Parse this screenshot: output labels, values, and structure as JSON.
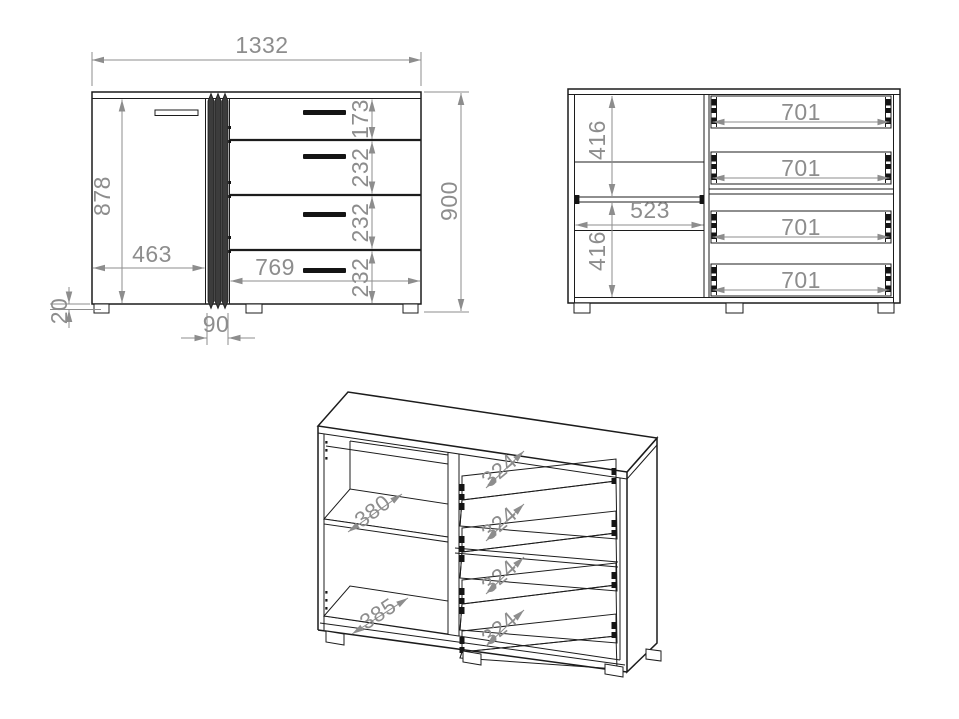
{
  "drawing": {
    "front_view": {
      "total_width": "1332",
      "total_height": "900",
      "front_height": "878",
      "door_width": "463",
      "drawer_front_width": "769",
      "center_strip_width": "90",
      "base_gap_height": "20",
      "drawer_front_heights": [
        "173",
        "232",
        "232",
        "232"
      ]
    },
    "carcass_view": {
      "upper_compartment_height": "416",
      "lower_compartment_height": "416",
      "interior_width": "523",
      "drawer_box_widths": [
        "701",
        "701",
        "701",
        "701"
      ]
    },
    "perspective_view": {
      "shelf_depth": "380",
      "bottom_panel_depth": "385",
      "drawer_box_depths": [
        "324",
        "324",
        "324",
        "324"
      ]
    },
    "colors": {
      "outline": "#1c1c1c",
      "dimension": "#8d8d8d",
      "background": "#ffffff",
      "strip_fill": "#3c3c3c",
      "handle_fill": "#141414"
    }
  }
}
